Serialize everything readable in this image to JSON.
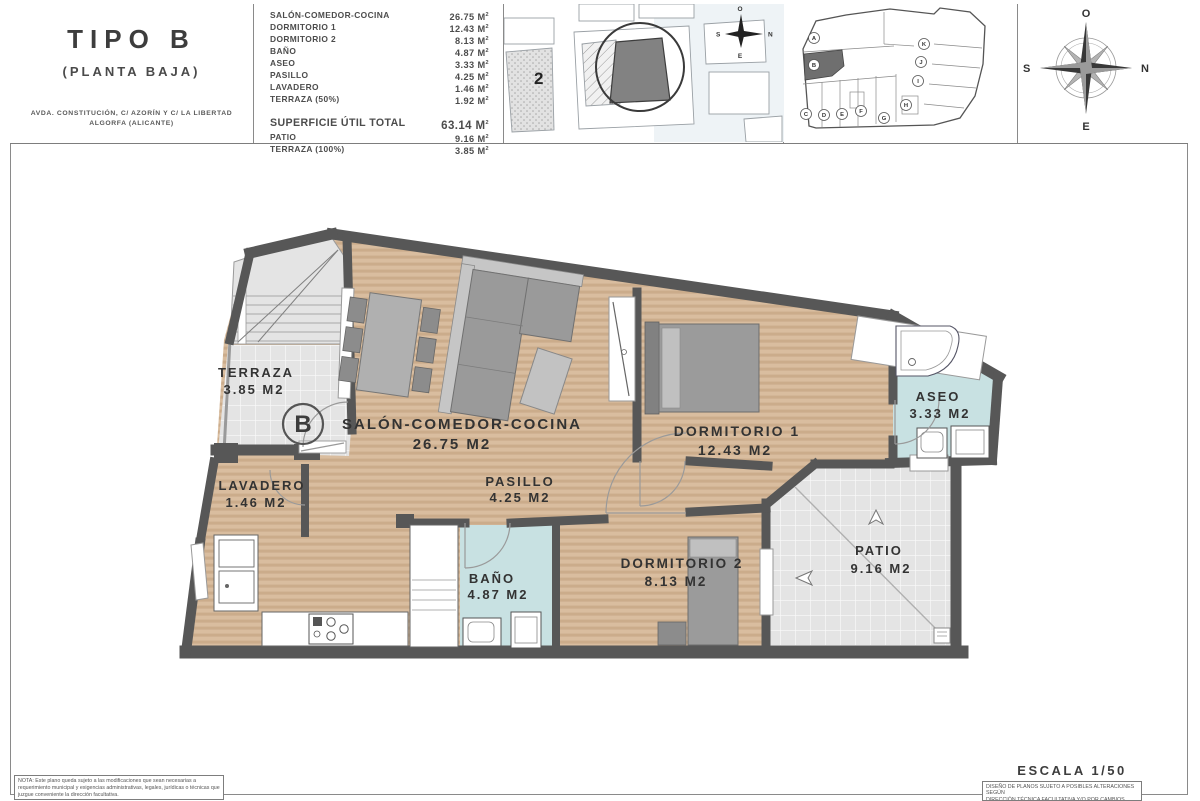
{
  "title_block": {
    "title": "TIPO B",
    "subtitle": "(PLANTA BAJA)",
    "address_line1": "AVDA. CONSTITUCIÓN, C/ AZORÍN Y C/ LA LIBERTAD",
    "address_line2": "ALGORFA (ALICANTE)"
  },
  "areas_table": {
    "unit_m": "M",
    "unit_sup": "2",
    "rows": [
      {
        "label": "SALÓN-COMEDOR-COCINA",
        "value": "26.75"
      },
      {
        "label": "DORMITORIO 1",
        "value": "12.43"
      },
      {
        "label": "DORMITORIO 2",
        "value": "8.13"
      },
      {
        "label": "BAÑO",
        "value": "4.87"
      },
      {
        "label": "ASEO",
        "value": "3.33"
      },
      {
        "label": "PASILLO",
        "value": "4.25"
      },
      {
        "label": "LAVADERO",
        "value": "1.46"
      },
      {
        "label": "TERRAZA (50%)",
        "value": "1.92"
      }
    ],
    "total": {
      "label": "SUPERFICIE ÚTIL TOTAL",
      "value": "63.14"
    },
    "extra_rows": [
      {
        "label": "PATIO",
        "value": "9.16"
      },
      {
        "label": "TERRAZA (100%)",
        "value": "3.85"
      }
    ]
  },
  "site_plan": {
    "plot_label": "2"
  },
  "block_plan": {
    "units": [
      "A",
      "B",
      "C",
      "D",
      "E",
      "F",
      "G",
      "H",
      "I",
      "J",
      "K"
    ],
    "highlighted": "B"
  },
  "compass": {
    "top": "O",
    "right": "N",
    "bottom": "E",
    "left": "S"
  },
  "floor_plan": {
    "unit_label": "B",
    "rooms": [
      {
        "name": "TERRAZA",
        "area": "3.85 M2"
      },
      {
        "name": "SALÓN-COMEDOR-COCINA",
        "area": "26.75 M2"
      },
      {
        "name": "DORMITORIO 1",
        "area": "12.43 M2"
      },
      {
        "name": "ASEO",
        "area": "3.33 M2"
      },
      {
        "name": "LAVADERO",
        "area": "1.46 M2"
      },
      {
        "name": "PASILLO",
        "area": "4.25 M2"
      },
      {
        "name": "BAÑO",
        "area": "4.87 M2"
      },
      {
        "name": "DORMITORIO 2",
        "area": "8.13 M2"
      },
      {
        "name": "PATIO",
        "area": "9.16 M2"
      }
    ]
  },
  "footer": {
    "note_left": "NOTA: Este plano queda sujeto a las modificaciones que sean necesarias a requerimiento municipal y exigencias administrativas, legales, jurídicas o técnicas que juzgue conveniente la dirección facultativa.",
    "scale_label": "ESCALA 1/50",
    "note_right_line1": "DISEÑO DE PLANOS SUJETO A POSIBLES ALTERACIONES SEGÚN",
    "note_right_line2": "DIRECCIÓN TÉCNICA FACULTATIVA Y/O POR CAMBIOS"
  },
  "colors": {
    "wood": "#d9bd9f",
    "wood_stripe": "#cbac8b",
    "tile": "#e4e4e4",
    "bath_blue": "#c8e1e2",
    "wall": "#575757",
    "furniture": "#9a9a9a"
  }
}
